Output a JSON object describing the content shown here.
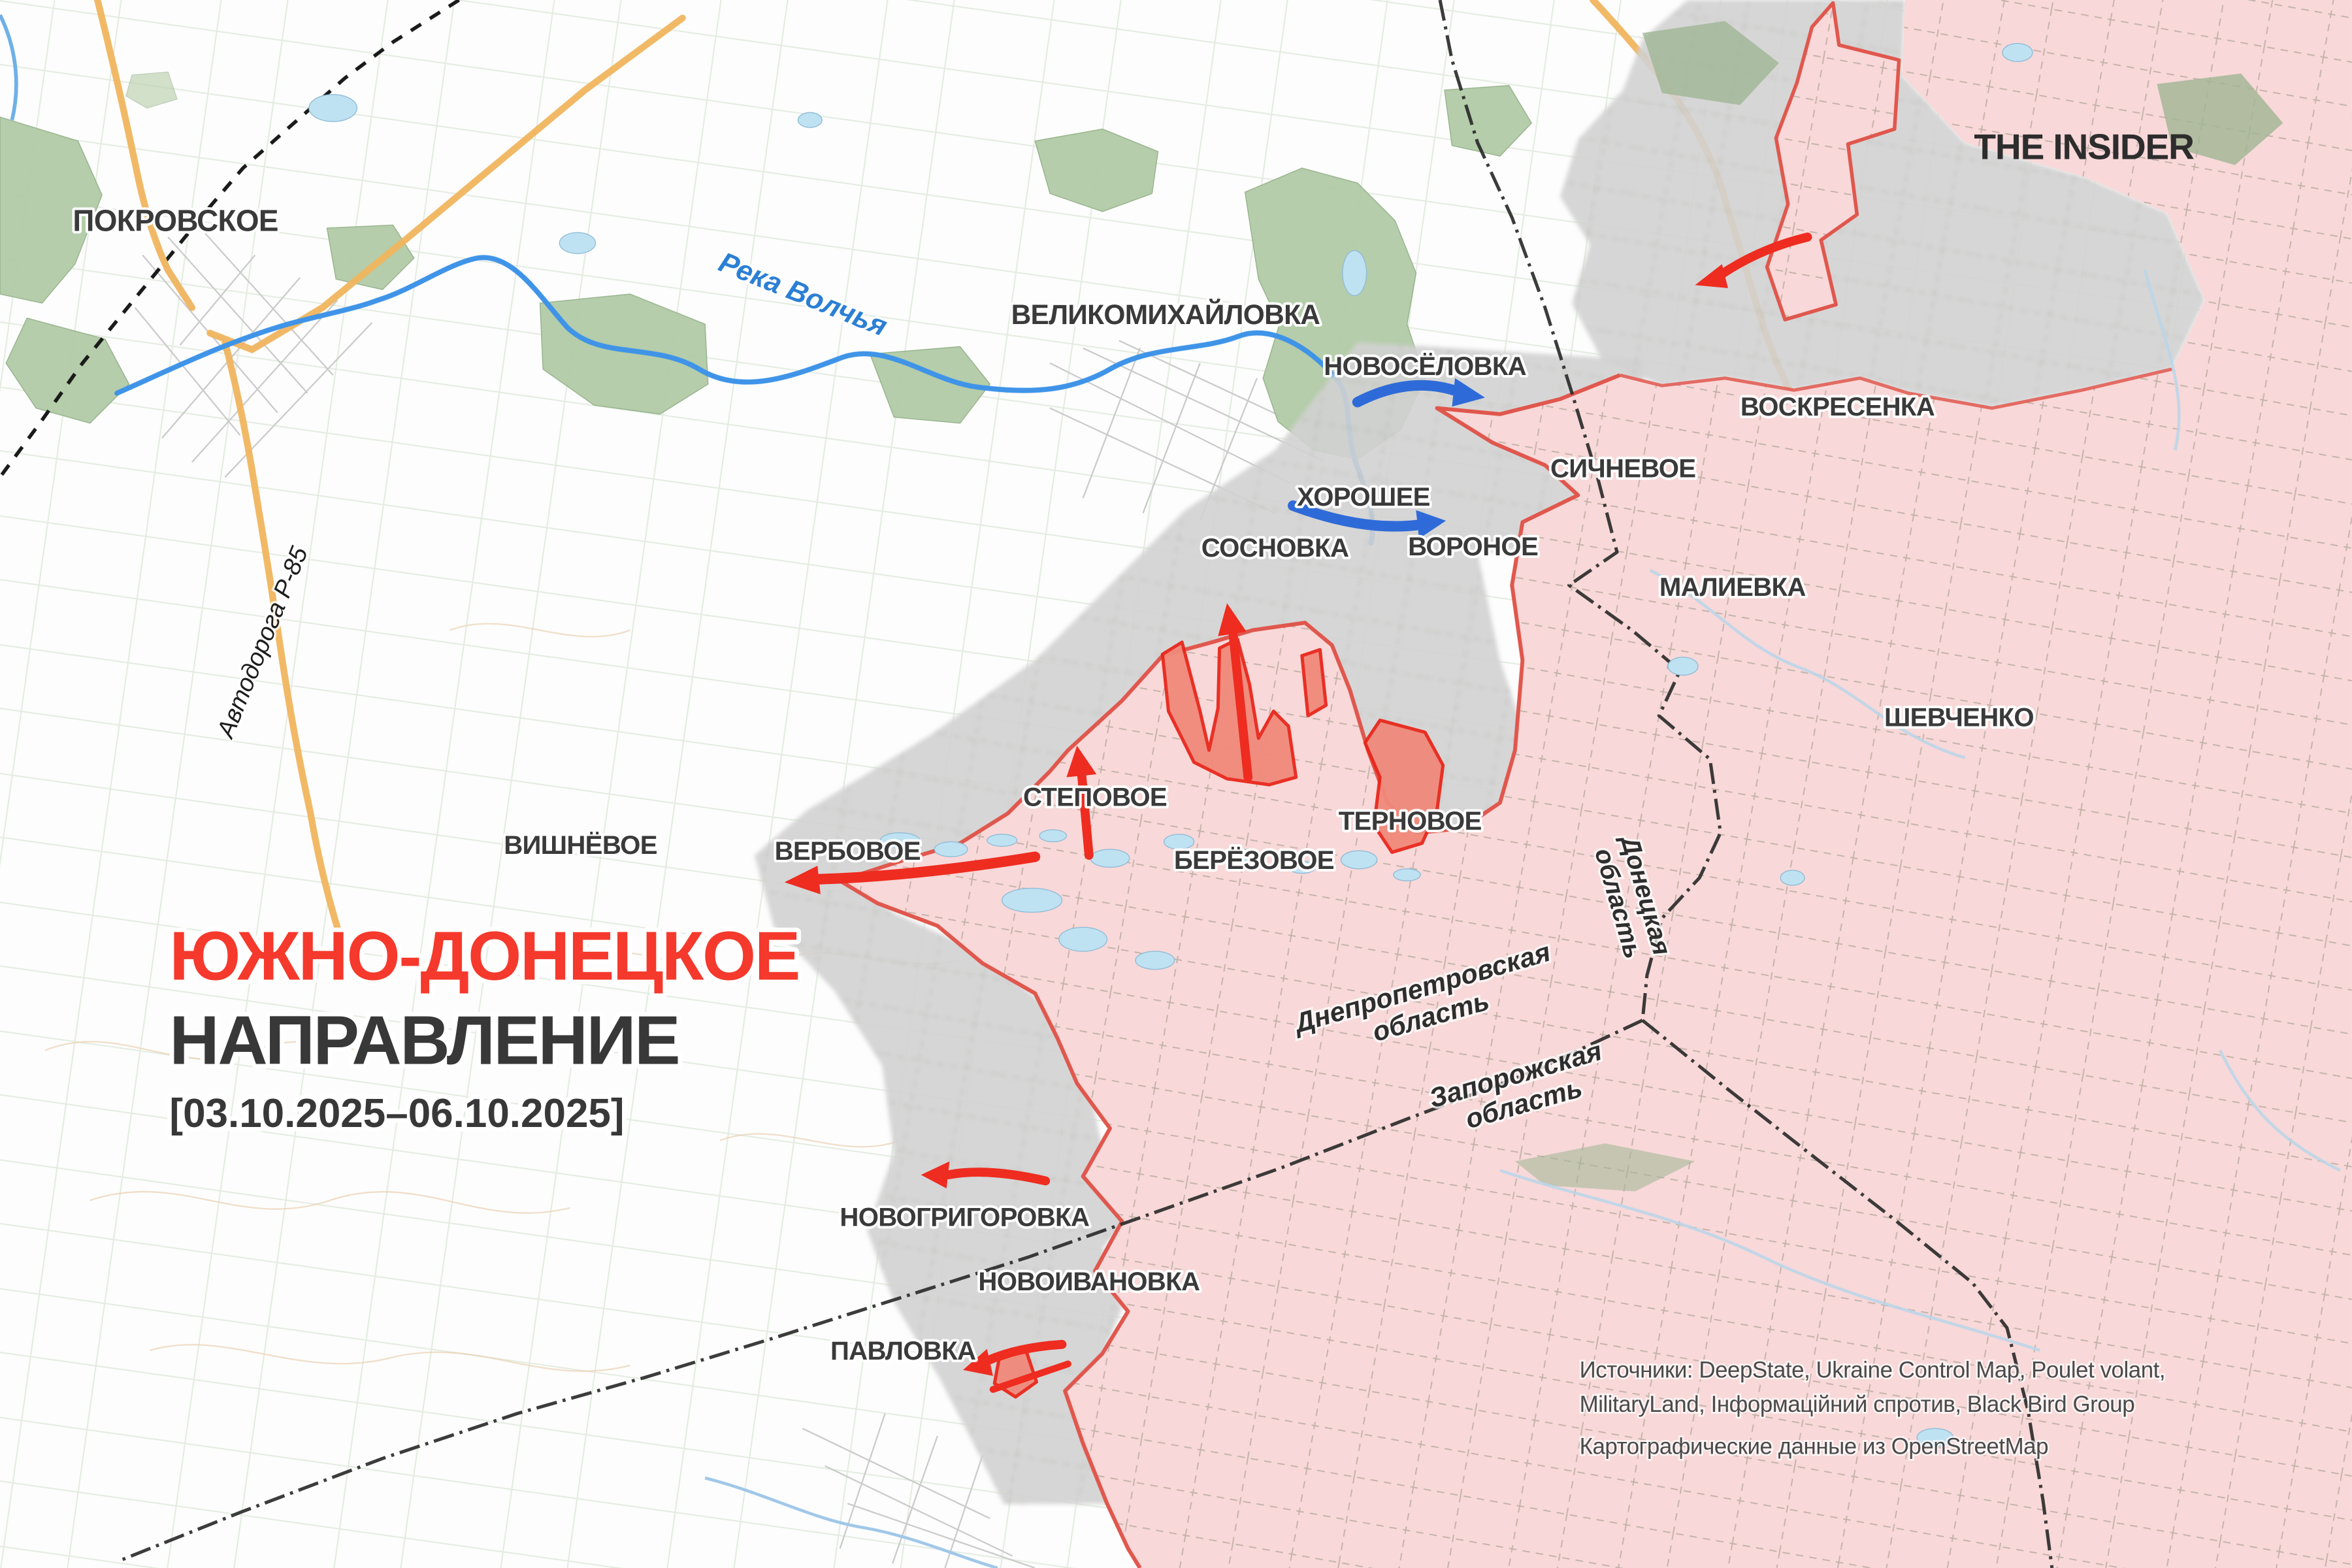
{
  "brand": "THE INSIDER",
  "title": {
    "line1": "ЮЖНО-ДОНЕЦКОЕ",
    "line2": "НАПРАВЛЕНИЕ",
    "date_range": "[03.10.2025–06.10.2025]"
  },
  "sources": {
    "line1": "Источники: DeepState, Ukraine Control Map, Poulet volant,",
    "line2": "MilitaryLand, Інформаційний спротив, Black Bird Group",
    "line3": "Картографические данные из OpenStreetMap"
  },
  "labels": {
    "river": "Река Волчья",
    "road": "Автодорога Р-85"
  },
  "settlements": [
    {
      "id": "pokrovskoe",
      "name": "ПОКРОВСКОЕ"
    },
    {
      "id": "velikomikhaylovka",
      "name": "ВЕЛИКОМИХАЙЛОВКА"
    },
    {
      "id": "novosyolovka",
      "name": "НОВОСЁЛОВКА"
    },
    {
      "id": "khoroshee",
      "name": "ХОРОШЕЕ"
    },
    {
      "id": "sosnovka",
      "name": "СОСНОВКА"
    },
    {
      "id": "voronoe",
      "name": "ВОРОНОЕ"
    },
    {
      "id": "sichnevoe",
      "name": "СИЧНЕВОЕ"
    },
    {
      "id": "voskresenka",
      "name": "ВОСКРЕСЕНКА"
    },
    {
      "id": "malievka",
      "name": "МАЛИЕВКА"
    },
    {
      "id": "shevchenko",
      "name": "ШЕВЧЕНКО"
    },
    {
      "id": "stepovoe",
      "name": "СТЕПОВОЕ"
    },
    {
      "id": "ternovoe",
      "name": "ТЕРНОВОЕ"
    },
    {
      "id": "verbovoe",
      "name": "ВЕРБОВОЕ"
    },
    {
      "id": "beryozovoe",
      "name": "БЕРЁЗОВОЕ"
    },
    {
      "id": "vishnyovoe",
      "name": "ВИШНЁВОЕ"
    },
    {
      "id": "novogrigorovka",
      "name": "НОВОГРИГОРОВКА"
    },
    {
      "id": "novoivanovka",
      "name": "НОВОИВАНОВКА"
    },
    {
      "id": "pavlovka",
      "name": "ПАВЛОВКА"
    }
  ],
  "regions": [
    {
      "line1": "Днепропетровская",
      "line2": "область"
    },
    {
      "line1": "Запорожская",
      "line2": "область"
    },
    {
      "line1": "Донецкая",
      "line2": "область"
    }
  ],
  "arrows": [
    {
      "color": "red",
      "near": "Воскресенка",
      "direction": "west"
    },
    {
      "color": "red",
      "near": "Вербовое",
      "direction": "west"
    },
    {
      "color": "red",
      "near": "Степовое",
      "direction": "north"
    },
    {
      "color": "red",
      "near": "Сосновка",
      "direction": "north"
    },
    {
      "color": "red",
      "near": "Новогригоровка",
      "direction": "west"
    },
    {
      "color": "red",
      "near": "Павловка",
      "direction": "west"
    },
    {
      "color": "blue",
      "near": "Новосёловка",
      "direction": "east"
    },
    {
      "color": "blue",
      "near": "Хорошее",
      "direction": "east"
    }
  ],
  "colors": {
    "occupied": "#f8d8d8",
    "contested": "#d2d2d2",
    "frontline": "#e0574d",
    "salient": "#f0897b",
    "salient_border": "#e8281c",
    "red_arrow": "#ee2c20",
    "blue_arrow": "#2f6bd8",
    "title_red": "#f5392c",
    "text_dark": "#3a3a3a",
    "river": "#3f94e8",
    "road": "#f0b55e",
    "forest": "#b2cba6",
    "water": "#bfe2f2"
  }
}
